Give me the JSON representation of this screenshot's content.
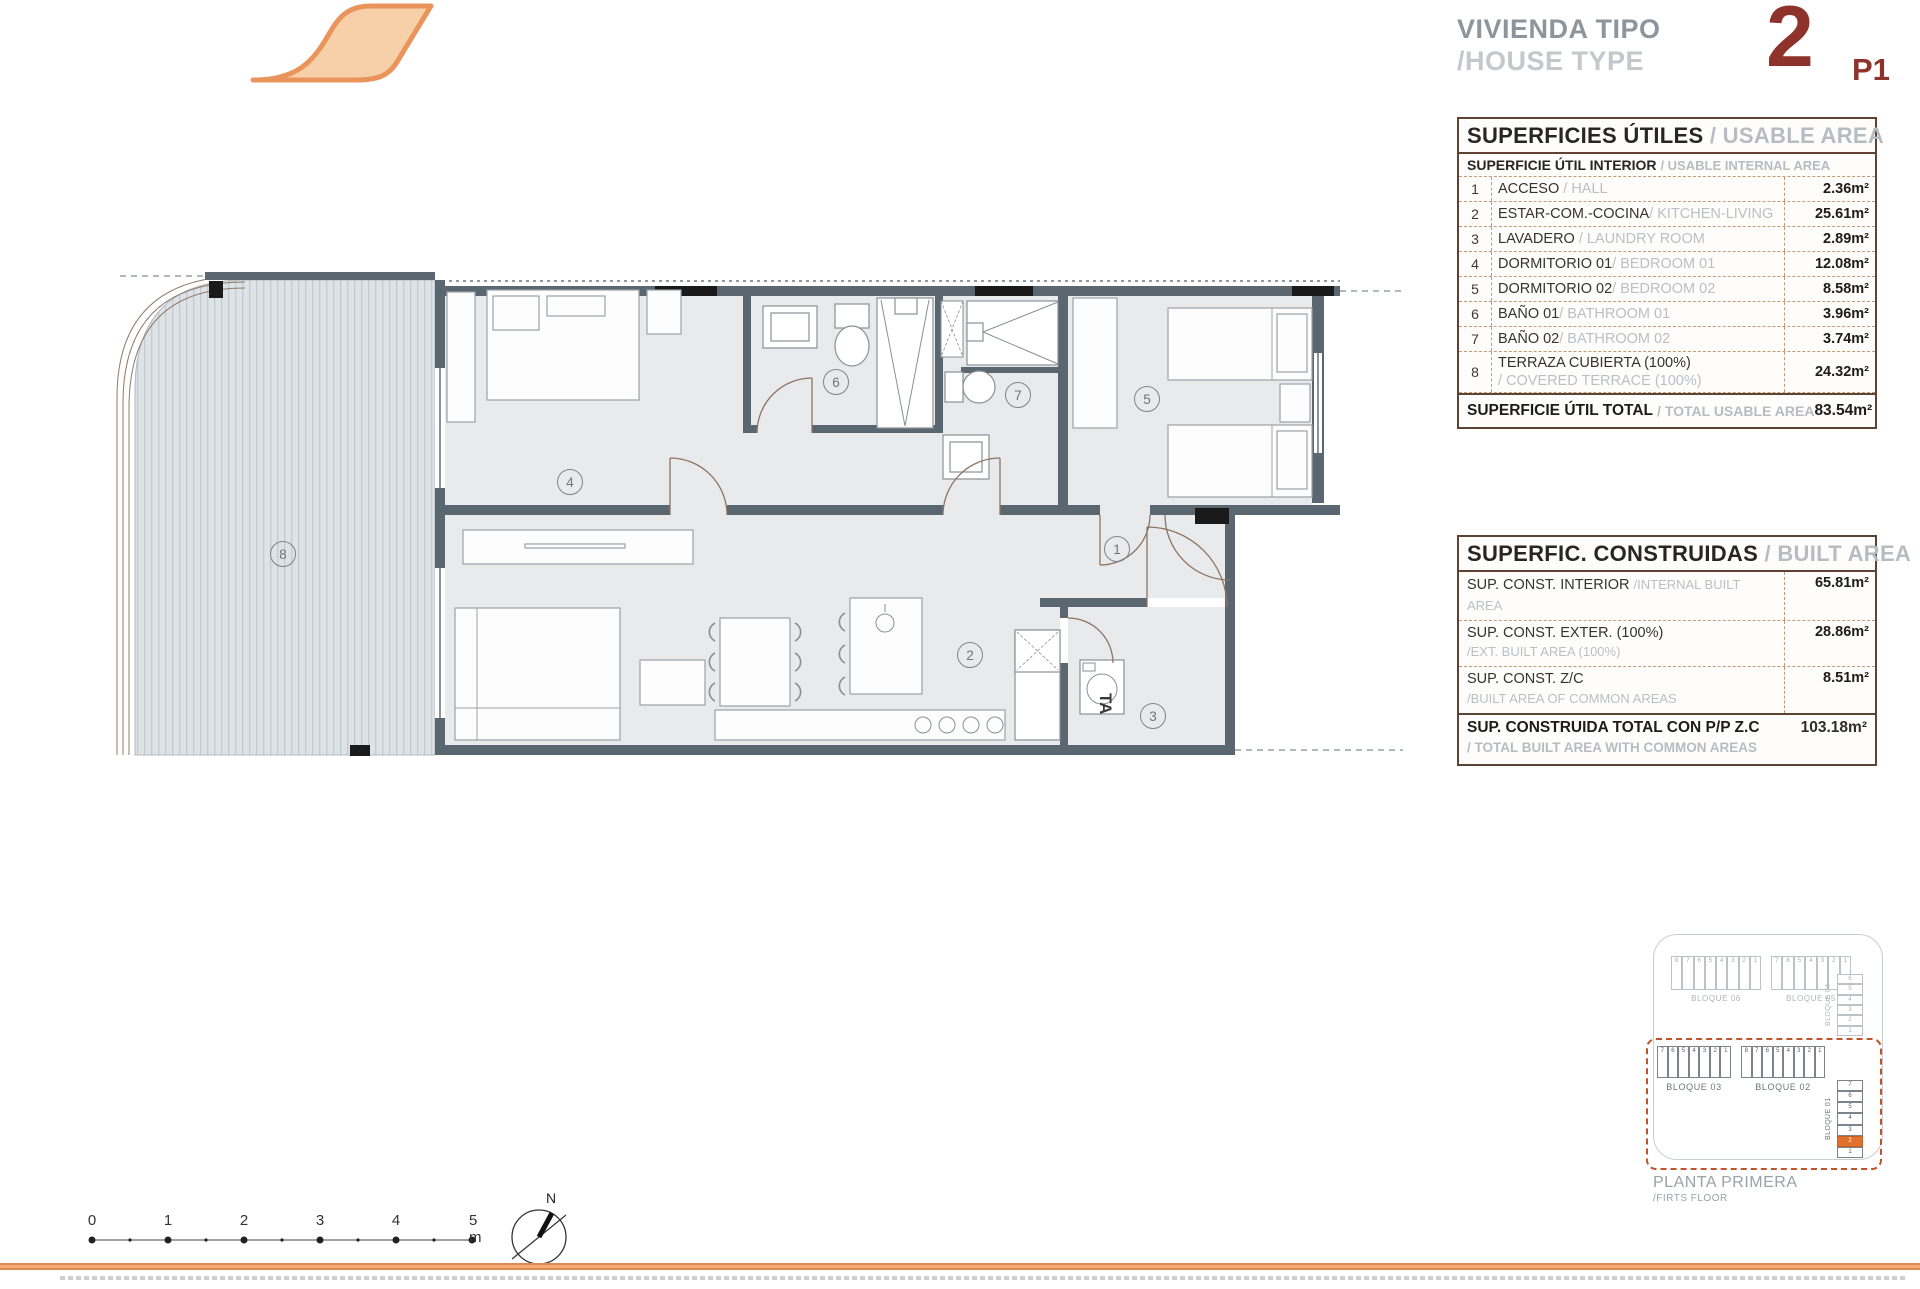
{
  "colors": {
    "accent_orange": "#ec9b63",
    "dark_red": "#8d332c",
    "wall_slate": "#5a6670",
    "highlight_orange": "#e2712e"
  },
  "header": {
    "title_es": "VIVIENDA TIPO",
    "title_en": "/HOUSE TYPE",
    "type_number": "2",
    "type_suffix": "P1"
  },
  "usable_table": {
    "title_es": "SUPERFICIES ÚTILES ",
    "title_en": "/ USABLE AREA",
    "subtitle_es": "SUPERFICIE ÚTIL INTERIOR ",
    "subtitle_en": "/ USABLE INTERNAL AREA",
    "rows": [
      {
        "num": "1",
        "name": "ACCESO",
        "name_en": " / HALL",
        "value": "2.36m²"
      },
      {
        "num": "2",
        "name": "ESTAR-COM.-COCINA",
        "name_en": "/ KITCHEN-LIVING",
        "value": "25.61m²"
      },
      {
        "num": "3",
        "name": "LAVADERO",
        "name_en": " / LAUNDRY ROOM",
        "value": "2.89m²"
      },
      {
        "num": "4",
        "name": "DORMITORIO 01",
        "name_en": "/ BEDROOM 01",
        "value": "12.08m²"
      },
      {
        "num": "5",
        "name": "DORMITORIO 02",
        "name_en": "/ BEDROOM 02",
        "value": "8.58m²"
      },
      {
        "num": "6",
        "name": "BAÑO 01",
        "name_en": "/ BATHROOM 01",
        "value": "3.96m²"
      },
      {
        "num": "7",
        "name": "BAÑO 02",
        "name_en": "/ BATHROOM 02",
        "value": "3.74m²"
      },
      {
        "num": "8",
        "name": "TERRAZA CUBIERTA (100%)",
        "name_en": "/ COVERED TERRACE (100%)",
        "value": "24.32m²"
      }
    ],
    "total_es": "SUPERFICIE ÚTIL TOTAL ",
    "total_en": "/ TOTAL USABLE AREA",
    "total_value": "83.54m²"
  },
  "built_table": {
    "title_es": "SUPERFIC. CONSTRUIDAS ",
    "title_en": "/ BUILT AREA",
    "rows": [
      {
        "name": "SUP. CONST. INTERIOR ",
        "name_en": "/INTERNAL BUILT AREA",
        "value": "65.81m²",
        "two_line": false
      },
      {
        "name": "SUP. CONST. EXTER. (100%)",
        "name_en": "/EXT. BUILT AREA (100%)",
        "value": "28.86m²",
        "two_line": true
      },
      {
        "name": "SUP. CONST. Z/C",
        "name_en": "/BUILT AREA OF COMMON AREAS",
        "value": "8.51m²",
        "two_line": true
      }
    ],
    "total_es": "SUP. CONSTRUIDA TOTAL CON P/P Z.C",
    "total_en": "/ TOTAL BUILT AREA WITH COMMON AREAS",
    "total_value": "103.18m²"
  },
  "plan": {
    "room_labels": [
      "1",
      "2",
      "3",
      "4",
      "5",
      "6",
      "7",
      "8"
    ],
    "ta_label": "TA"
  },
  "site_plan": {
    "caption": "PLANTA PRIMERA",
    "caption_sub": "/FIRTS FLOOR",
    "blocks": [
      {
        "label": "BLOQUE 06",
        "cells": [
          "8",
          "7",
          "6",
          "5",
          "4",
          "3",
          "2",
          "1"
        ]
      },
      {
        "label": "BLOQUE 05",
        "cells": [
          "7",
          "6",
          "5",
          "4",
          "3",
          "2",
          "1"
        ]
      },
      {
        "label": "BLOQUE 04",
        "cells": [
          "6",
          "5",
          "4",
          "3",
          "2",
          "1"
        ]
      },
      {
        "label": "BLOQUE 03",
        "cells": [
          "7",
          "6",
          "5",
          "4",
          "3",
          "2",
          "1"
        ]
      },
      {
        "label": "BLOQUE 02",
        "cells": [
          "8",
          "7",
          "6",
          "5",
          "4",
          "3",
          "2",
          "1"
        ]
      },
      {
        "label": "BLOQUE 01",
        "cells": [
          "7",
          "6",
          "5",
          "4",
          "3",
          "2",
          "1"
        ],
        "highlight": "2"
      }
    ]
  },
  "scale_bar": {
    "labels": [
      "0",
      "1",
      "2",
      "3",
      "4",
      "5 m"
    ]
  },
  "north": {
    "label": "N"
  }
}
